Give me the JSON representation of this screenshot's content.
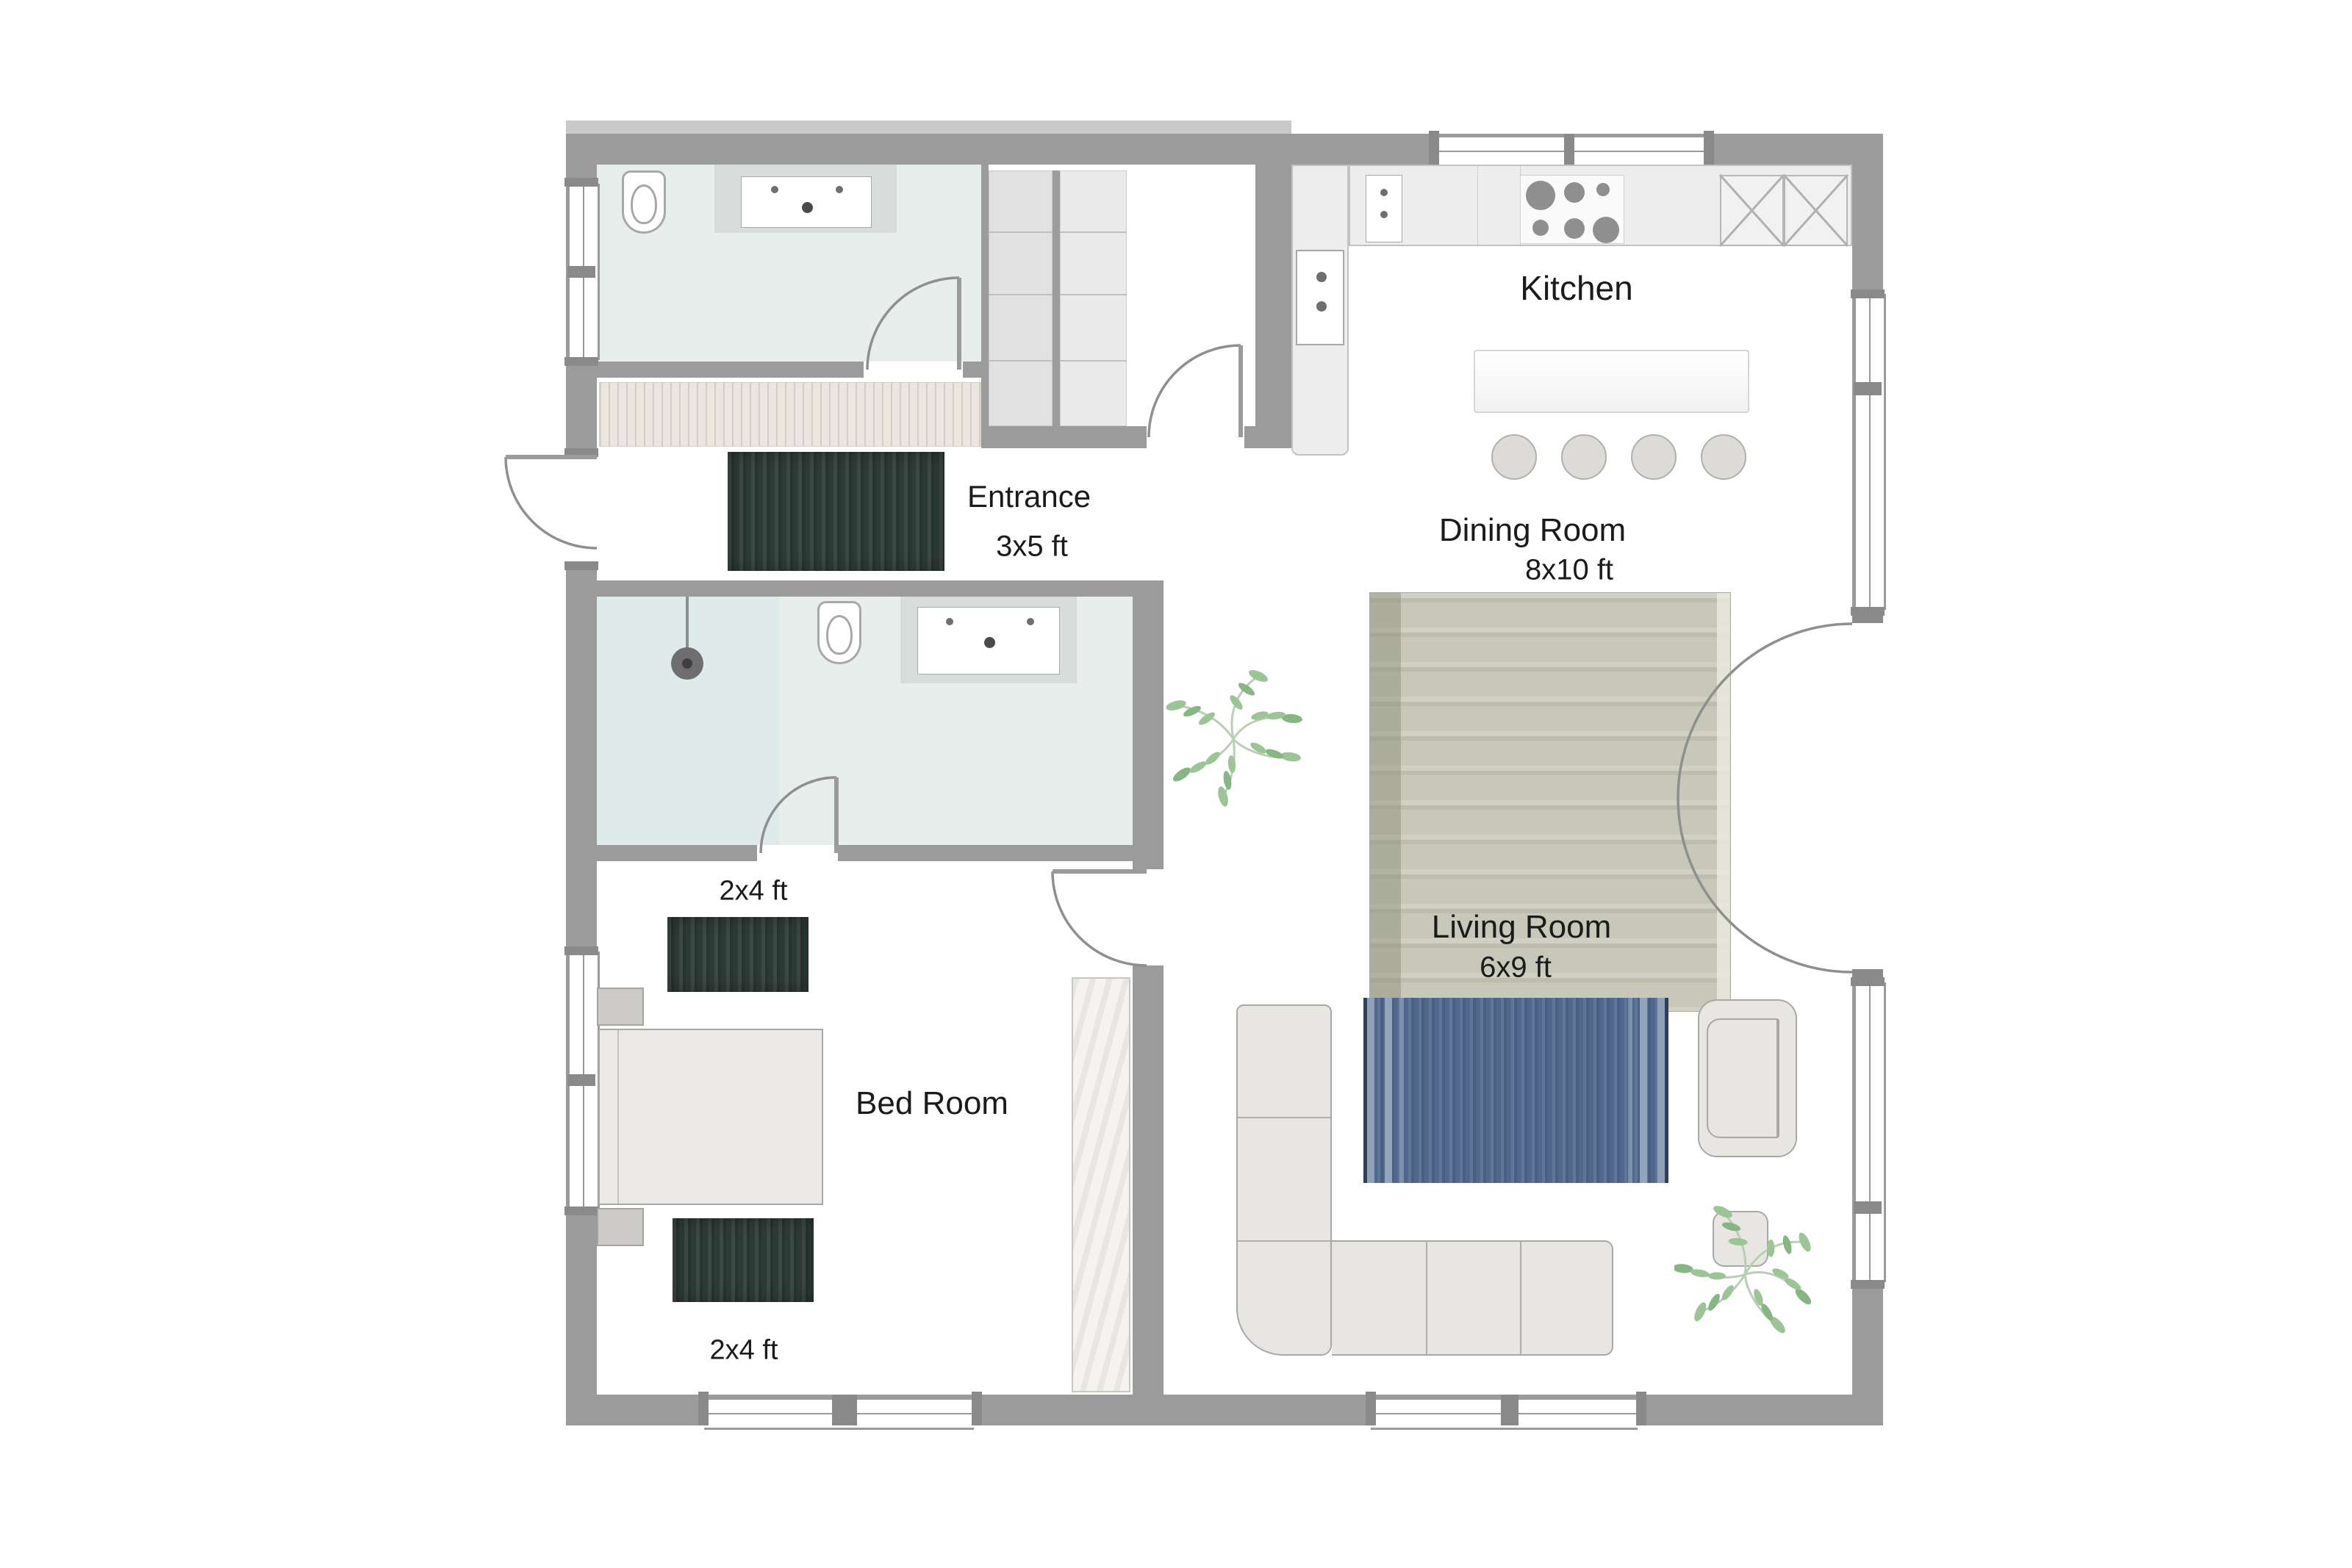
{
  "plan": {
    "title": "Apartment floor plan",
    "rooms": [
      {
        "name": "Kitchen"
      },
      {
        "name": "Dining Room",
        "rug_size": "8x10 ft"
      },
      {
        "name": "Living Room",
        "rug_size": "6x9 ft"
      },
      {
        "name": "Entrance",
        "rug_size": "3x5 ft"
      },
      {
        "name": "Bed Room",
        "rug_sizes": [
          "2x4 ft",
          "2x4 ft"
        ]
      },
      {
        "name": "Bathroom (top)"
      },
      {
        "name": "Bathroom (ensuite)"
      }
    ],
    "labels": {
      "kitchen": "Kitchen",
      "dining_room": "Dining Room",
      "dining_rug_size": "8x10 ft",
      "living_room": "Living Room",
      "living_rug_size": "6x9 ft",
      "entrance": "Entrance",
      "entrance_rug_size": "3x5 ft",
      "bed_room": "Bed Room",
      "bedroom_rug_top_size": "2x4 ft",
      "bedroom_rug_bottom_size": "2x4 ft"
    },
    "fixtures": [
      "toilet",
      "vanity-sink",
      "shower-head",
      "stove-burners",
      "oven-tower",
      "kitchen-sink",
      "pantry-x-cabinet",
      "kitchen-island",
      "bar-stool",
      "dining-rug",
      "living-rug",
      "entrance-rug",
      "bedroom-rug",
      "sectional-sofa",
      "armchair",
      "side-table",
      "bed",
      "nightstand",
      "wardrobe",
      "closet-shelves",
      "plant",
      "door",
      "double-french-door",
      "window"
    ],
    "colors": {
      "wall": "#9b9b9b",
      "bath_floor": "#e8eeec",
      "counter": "#ededed",
      "rug_dark_green": "#2d3b37",
      "rug_dining_beige": "#c7c8b9",
      "rug_blue": "#50688e",
      "furniture": "#e7e6e3",
      "plant_green": "#9cc497",
      "text": "#1b1b1b"
    }
  }
}
